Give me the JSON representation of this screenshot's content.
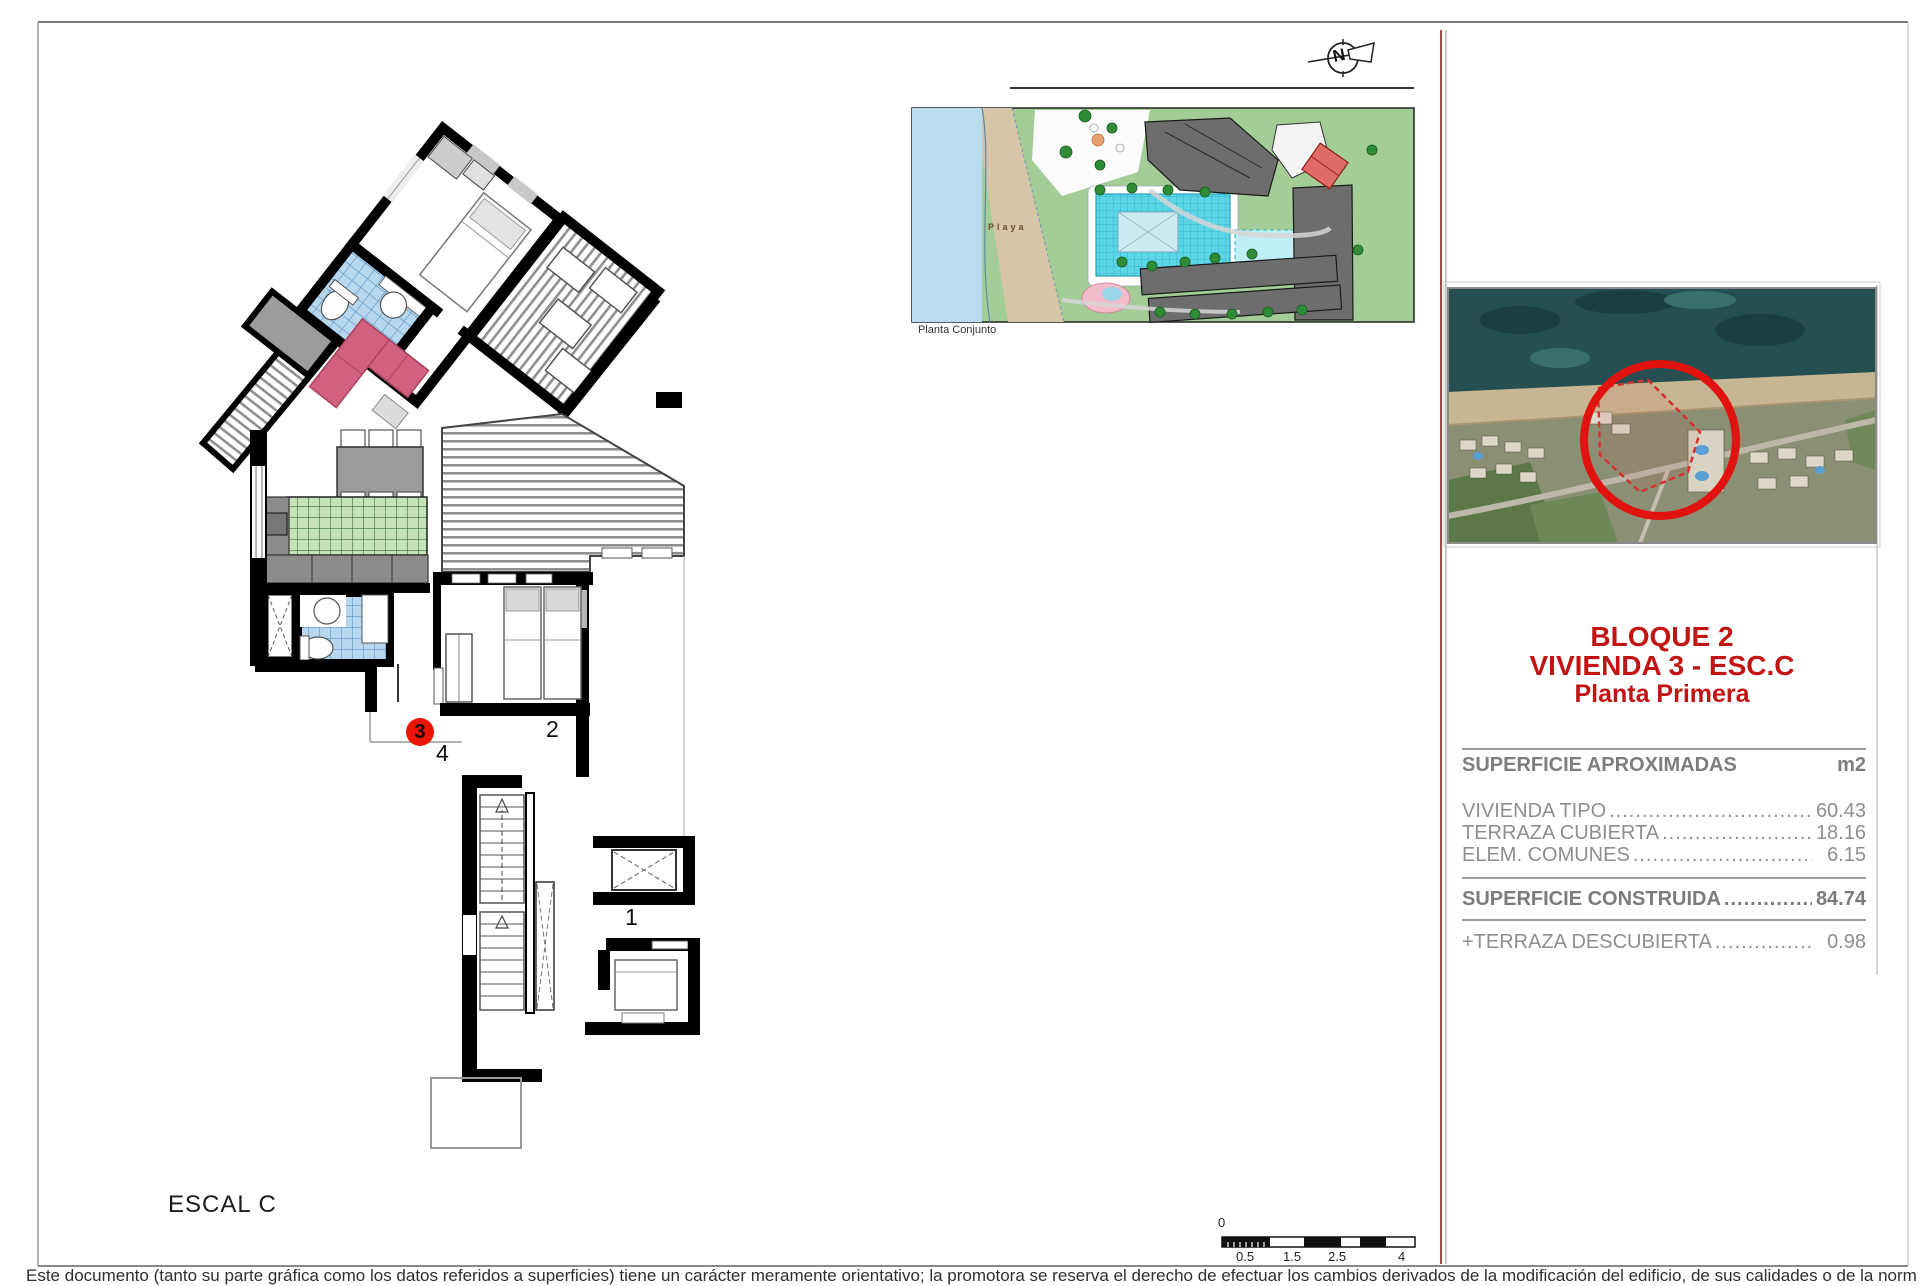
{
  "floor_plan": {
    "name_label": "ESCAL C",
    "marker_unit": "3",
    "unit_label_4": "4",
    "unit_label_2": "2",
    "unit_label_1": "1"
  },
  "site_plan": {
    "caption": "Planta Conjunto",
    "beach_label": "Playa",
    "north_label": "N"
  },
  "scale_bar": {
    "zero": "0",
    "labels": [
      "0.5",
      "1.5",
      "2.5",
      "4"
    ]
  },
  "info_panel": {
    "title_line1": "BLOQUE 2",
    "title_line2": "VIVIENDA 3 - ESC.C",
    "title_line3": "Planta Primera",
    "areas": {
      "header": "SUPERFICIE APROXIMADAS",
      "unit_header": "m2",
      "rows": [
        {
          "label": "VIVIENDA TIPO",
          "leader": "......................................................................",
          "value": "60.43"
        },
        {
          "label": "TERRAZA CUBIERTA",
          "leader": "......................................................................",
          "value": "18.16"
        },
        {
          "label": "ELEM. COMUNES",
          "leader": "......................................................................",
          "value": "6.15"
        }
      ],
      "total": {
        "label": "SUPERFICIE CONSTRUIDA",
        "leader": "......................................................................",
        "value": "84.74"
      },
      "extra": {
        "label": "+TERRAZA DESCUBIERTA",
        "leader": "......................................................................",
        "value": "0.98"
      }
    }
  },
  "page": {
    "disclaimer": "Este documento (tanto su parte gráfica como los datos referidos a superficies) tiene un carácter meramente orientativo; la promotora se reserva el derecho de efectuar los cambios derivados de la modificación del edificio, de sus calidades o de la normativa de aplicación, sin que pueda exigirse la clasificación del edificio."
  },
  "colors": {
    "accent_red": "#c31414",
    "marker_red": "#ea1408",
    "table_gray": "#8e8e8e",
    "tile_blue": "#b6d7ee",
    "tile_green": "#c6e2b8",
    "sofa_pink": "#d2607e",
    "water_blue": "#b9ddef",
    "sand_tan": "#d6c5a7",
    "site_green": "#a3cc97",
    "pool_cyan": "#5cd6e6",
    "building_gray": "#6d6d6d",
    "wall_black": "#000000"
  }
}
